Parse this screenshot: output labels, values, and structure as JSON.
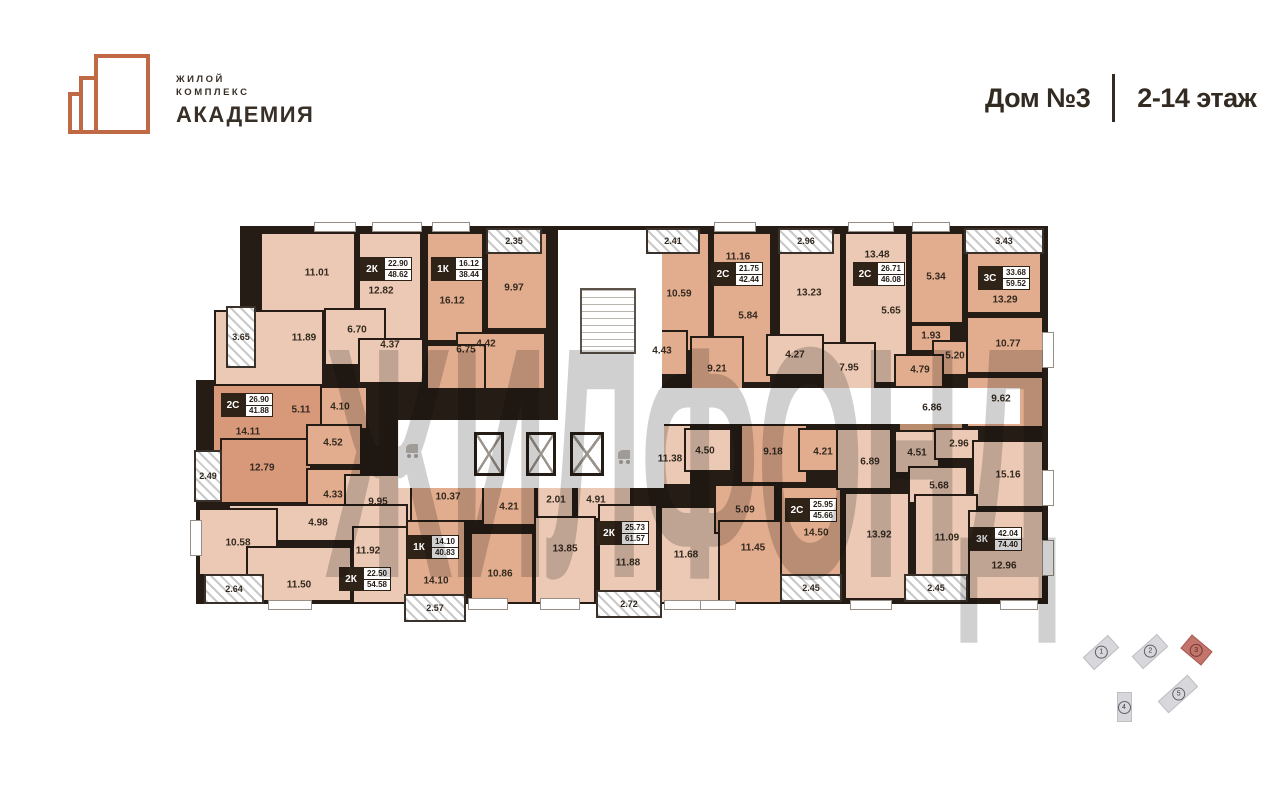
{
  "header": {
    "logo_line1": "ЖИЛОЙ",
    "logo_line2": "КОМПЛЕКС",
    "logo_name": "АКАДЕМИЯ",
    "house": "Дом №3",
    "floors": "2-14 этаж"
  },
  "watermark": "ЖИЛФОНД",
  "colors": {
    "brand": "#c06a45",
    "wall": "#251d15",
    "room_light": "#ecc9b4",
    "room_mid": "#e2ad8e",
    "room_dark": "#d8997a",
    "room_deep": "#b98c6d",
    "minimap_highlight": "#c4756b"
  },
  "plan": {
    "apartments": [
      {
        "type": "2К",
        "living": "22.90",
        "total": "48.62",
        "x": 360,
        "y": 257
      },
      {
        "type": "1К",
        "living": "16.12",
        "total": "38.44",
        "x": 431,
        "y": 257
      },
      {
        "type": "2С",
        "living": "21.75",
        "total": "42.44",
        "x": 711,
        "y": 262
      },
      {
        "type": "2С",
        "living": "26.71",
        "total": "46.08",
        "x": 853,
        "y": 262
      },
      {
        "type": "3С",
        "living": "33.68",
        "total": "59.52",
        "x": 978,
        "y": 266
      },
      {
        "type": "2С",
        "living": "26.90",
        "total": "41.88",
        "x": 221,
        "y": 393
      },
      {
        "type": "1К",
        "living": "14.10",
        "total": "40.83",
        "x": 407,
        "y": 535
      },
      {
        "type": "2К",
        "living": "22.50",
        "total": "54.58",
        "x": 339,
        "y": 567
      },
      {
        "type": "2К",
        "living": "25.73",
        "total": "61.57",
        "x": 597,
        "y": 521
      },
      {
        "type": "2С",
        "living": "25.95",
        "total": "45.66",
        "x": 785,
        "y": 498
      },
      {
        "type": "3К",
        "living": "42.04",
        "total": "74.40",
        "x": 970,
        "y": 527
      }
    ],
    "rooms": [
      {
        "r": [
          260,
          232,
          96,
          88
        ],
        "f": "light"
      },
      {
        "r": [
          358,
          232,
          64,
          120
        ],
        "f": "light"
      },
      {
        "r": [
          324,
          308,
          62,
          58
        ],
        "f": "light"
      },
      {
        "r": [
          358,
          338,
          66,
          46
        ],
        "f": "light"
      },
      {
        "r": [
          214,
          310,
          110,
          82
        ],
        "f": "light"
      },
      {
        "r": [
          426,
          232,
          58,
          110
        ],
        "f": "mid"
      },
      {
        "r": [
          486,
          232,
          62,
          98
        ],
        "f": "mid"
      },
      {
        "r": [
          456,
          332,
          90,
          58
        ],
        "f": "mid"
      },
      {
        "r": [
          426,
          344,
          60,
          46
        ],
        "f": "mid"
      },
      {
        "r": [
          646,
          232,
          64,
          120
        ],
        "f": "mid"
      },
      {
        "r": [
          712,
          232,
          60,
          152
        ],
        "f": "mid"
      },
      {
        "r": [
          638,
          330,
          50,
          46
        ],
        "f": "mid"
      },
      {
        "r": [
          690,
          336,
          54,
          68
        ],
        "f": "mid"
      },
      {
        "r": [
          778,
          232,
          64,
          114
        ],
        "f": "light"
      },
      {
        "r": [
          844,
          232,
          64,
          152
        ],
        "f": "light"
      },
      {
        "r": [
          766,
          334,
          58,
          42
        ],
        "f": "light"
      },
      {
        "r": [
          822,
          342,
          54,
          52
        ],
        "f": "light"
      },
      {
        "r": [
          910,
          232,
          54,
          92
        ],
        "f": "mid"
      },
      {
        "r": [
          966,
          232,
          76,
          82
        ],
        "f": "mid"
      },
      {
        "r": [
          910,
          324,
          42,
          28
        ],
        "f": "mid"
      },
      {
        "r": [
          932,
          340,
          50,
          36
        ],
        "f": "mid"
      },
      {
        "r": [
          894,
          354,
          50,
          34
        ],
        "f": "mid"
      },
      {
        "r": [
          966,
          316,
          78,
          58
        ],
        "f": "mid"
      },
      {
        "r": [
          966,
          376,
          78,
          52
        ],
        "f": "mid"
      },
      {
        "r": [
          898,
          388,
          66,
          44
        ],
        "f": "deep"
      },
      {
        "r": [
          212,
          384,
          136,
          72
        ],
        "f": "dark"
      },
      {
        "r": [
          320,
          386,
          48,
          44
        ],
        "f": "mid"
      },
      {
        "r": [
          220,
          438,
          92,
          66
        ],
        "f": "dark"
      },
      {
        "r": [
          306,
          424,
          56,
          42
        ],
        "f": "mid"
      },
      {
        "r": [
          306,
          468,
          56,
          46
        ],
        "f": "mid"
      },
      {
        "r": [
          344,
          474,
          82,
          50
        ],
        "f": "light"
      },
      {
        "r": [
          228,
          504,
          180,
          38
        ],
        "f": "light"
      },
      {
        "r": [
          198,
          508,
          80,
          68
        ],
        "f": "light"
      },
      {
        "r": [
          246,
          546,
          106,
          56
        ],
        "f": "light"
      },
      {
        "r": [
          352,
          526,
          76,
          78
        ],
        "f": "light"
      },
      {
        "r": [
          410,
          474,
          76,
          48
        ],
        "f": "mid"
      },
      {
        "r": [
          482,
          480,
          54,
          46
        ],
        "f": "mid"
      },
      {
        "r": [
          406,
          520,
          60,
          84
        ],
        "f": "mid"
      },
      {
        "r": [
          470,
          532,
          64,
          72
        ],
        "f": "mid"
      },
      {
        "r": [
          536,
          484,
          38,
          34
        ],
        "f": "light"
      },
      {
        "r": [
          576,
          482,
          56,
          38
        ],
        "f": "light"
      },
      {
        "r": [
          534,
          516,
          62,
          88
        ],
        "f": "light"
      },
      {
        "r": [
          598,
          504,
          60,
          100
        ],
        "f": "light"
      },
      {
        "r": [
          660,
          506,
          64,
          98
        ],
        "f": "light"
      },
      {
        "r": [
          634,
          424,
          58,
          62
        ],
        "f": "light"
      },
      {
        "r": [
          684,
          428,
          48,
          44
        ],
        "f": "light"
      },
      {
        "r": [
          740,
          424,
          68,
          60
        ],
        "f": "mid"
      },
      {
        "r": [
          798,
          428,
          52,
          44
        ],
        "f": "mid"
      },
      {
        "r": [
          714,
          484,
          62,
          50
        ],
        "f": "mid"
      },
      {
        "r": [
          718,
          520,
          68,
          84
        ],
        "f": "mid"
      },
      {
        "r": [
          780,
          486,
          62,
          100
        ],
        "f": "mid"
      },
      {
        "r": [
          836,
          428,
          56,
          62
        ],
        "f": "light"
      },
      {
        "r": [
          894,
          430,
          46,
          44
        ],
        "f": "light"
      },
      {
        "r": [
          934,
          428,
          46,
          32
        ],
        "f": "light"
      },
      {
        "r": [
          908,
          466,
          60,
          38
        ],
        "f": "light"
      },
      {
        "r": [
          972,
          440,
          72,
          68
        ],
        "f": "light"
      },
      {
        "r": [
          844,
          492,
          66,
          108
        ],
        "f": "light"
      },
      {
        "r": [
          914,
          494,
          64,
          106
        ],
        "f": "light"
      },
      {
        "r": [
          968,
          510,
          76,
          90
        ],
        "f": "light"
      }
    ],
    "labels": [
      {
        "t": "11.01",
        "x": 317,
        "y": 273
      },
      {
        "t": "12.82",
        "x": 381,
        "y": 291
      },
      {
        "t": "6.70",
        "x": 357,
        "y": 330
      },
      {
        "t": "4.37",
        "x": 390,
        "y": 345
      },
      {
        "t": "11.89",
        "x": 304,
        "y": 338
      },
      {
        "t": "16.12",
        "x": 452,
        "y": 301
      },
      {
        "t": "9.97",
        "x": 514,
        "y": 288
      },
      {
        "t": "4.42",
        "x": 486,
        "y": 344
      },
      {
        "t": "6.75",
        "x": 466,
        "y": 350
      },
      {
        "t": "10.59",
        "x": 679,
        "y": 294
      },
      {
        "t": "11.16",
        "x": 738,
        "y": 257
      },
      {
        "t": "5.84",
        "x": 748,
        "y": 316
      },
      {
        "t": "4.43",
        "x": 662,
        "y": 351
      },
      {
        "t": "9.21",
        "x": 717,
        "y": 369
      },
      {
        "t": "13.23",
        "x": 809,
        "y": 293
      },
      {
        "t": "13.48",
        "x": 877,
        "y": 255
      },
      {
        "t": "5.65",
        "x": 891,
        "y": 311
      },
      {
        "t": "4.27",
        "x": 795,
        "y": 355
      },
      {
        "t": "7.95",
        "x": 849,
        "y": 368
      },
      {
        "t": "13.29",
        "x": 1005,
        "y": 300
      },
      {
        "t": "5.34",
        "x": 936,
        "y": 277
      },
      {
        "t": "1.93",
        "x": 931,
        "y": 336
      },
      {
        "t": "5.20",
        "x": 955,
        "y": 356
      },
      {
        "t": "4.79",
        "x": 920,
        "y": 370
      },
      {
        "t": "10.77",
        "x": 1008,
        "y": 344
      },
      {
        "t": "9.62",
        "x": 1001,
        "y": 399
      },
      {
        "t": "6.86",
        "x": 932,
        "y": 408
      },
      {
        "t": "14.11",
        "x": 248,
        "y": 432
      },
      {
        "t": "5.11",
        "x": 301,
        "y": 410
      },
      {
        "t": "4.10",
        "x": 340,
        "y": 407
      },
      {
        "t": "4.52",
        "x": 333,
        "y": 443
      },
      {
        "t": "12.79",
        "x": 262,
        "y": 468
      },
      {
        "t": "4.33",
        "x": 333,
        "y": 495
      },
      {
        "t": "9.95",
        "x": 378,
        "y": 502
      },
      {
        "t": "4.98",
        "x": 318,
        "y": 523
      },
      {
        "t": "10.58",
        "x": 238,
        "y": 543
      },
      {
        "t": "11.50",
        "x": 299,
        "y": 585
      },
      {
        "t": "11.92",
        "x": 368,
        "y": 551
      },
      {
        "t": "10.37",
        "x": 448,
        "y": 497
      },
      {
        "t": "4.21",
        "x": 509,
        "y": 507
      },
      {
        "t": "14.10",
        "x": 436,
        "y": 581
      },
      {
        "t": "10.86",
        "x": 500,
        "y": 574
      },
      {
        "t": "2.01",
        "x": 556,
        "y": 500
      },
      {
        "t": "4.91",
        "x": 596,
        "y": 500
      },
      {
        "t": "13.85",
        "x": 565,
        "y": 549
      },
      {
        "t": "11.88",
        "x": 628,
        "y": 563
      },
      {
        "t": "11.68",
        "x": 686,
        "y": 555
      },
      {
        "t": "11.38",
        "x": 670,
        "y": 459
      },
      {
        "t": "4.50",
        "x": 705,
        "y": 451
      },
      {
        "t": "9.18",
        "x": 773,
        "y": 452
      },
      {
        "t": "4.21",
        "x": 823,
        "y": 452
      },
      {
        "t": "5.09",
        "x": 745,
        "y": 510
      },
      {
        "t": "11.45",
        "x": 753,
        "y": 548
      },
      {
        "t": "14.50",
        "x": 816,
        "y": 533
      },
      {
        "t": "13.92",
        "x": 879,
        "y": 535
      },
      {
        "t": "11.09",
        "x": 947,
        "y": 538
      },
      {
        "t": "12.96",
        "x": 1004,
        "y": 566
      },
      {
        "t": "6.89",
        "x": 870,
        "y": 462
      },
      {
        "t": "4.51",
        "x": 917,
        "y": 453
      },
      {
        "t": "2.96",
        "x": 959,
        "y": 444
      },
      {
        "t": "5.68",
        "x": 939,
        "y": 486
      },
      {
        "t": "15.16",
        "x": 1008,
        "y": 475
      }
    ],
    "balconies": [
      {
        "t": "2.35",
        "r": [
          486,
          228,
          56,
          26
        ]
      },
      {
        "t": "2.41",
        "r": [
          646,
          228,
          54,
          26
        ]
      },
      {
        "t": "2.96",
        "r": [
          778,
          228,
          56,
          26
        ]
      },
      {
        "t": "3.43",
        "r": [
          964,
          228,
          80,
          26
        ]
      },
      {
        "t": "3.65",
        "r": [
          226,
          306,
          30,
          62
        ]
      },
      {
        "t": "2.49",
        "r": [
          194,
          450,
          28,
          52
        ]
      },
      {
        "t": "2.64",
        "r": [
          204,
          574,
          60,
          30
        ]
      },
      {
        "t": "2.57",
        "r": [
          404,
          594,
          62,
          28
        ]
      },
      {
        "t": "2.72",
        "r": [
          596,
          590,
          66,
          28
        ]
      },
      {
        "t": "2.45",
        "r": [
          780,
          574,
          62,
          28
        ]
      },
      {
        "t": "2.45",
        "r": [
          904,
          574,
          64,
          28
        ]
      }
    ]
  },
  "minimap": {
    "buildings": [
      {
        "num": "1",
        "cx": 1101,
        "cy": 652,
        "w": 34,
        "h": 17,
        "rot": -42,
        "highlighted": false
      },
      {
        "num": "2",
        "cx": 1150,
        "cy": 651,
        "w": 34,
        "h": 17,
        "rot": -42,
        "highlighted": false
      },
      {
        "num": "3",
        "cx": 1196,
        "cy": 650,
        "w": 27,
        "h": 18,
        "rot": 40,
        "highlighted": true
      },
      {
        "num": "4",
        "cx": 1124,
        "cy": 707,
        "w": 15,
        "h": 30,
        "rot": 0,
        "highlighted": false
      },
      {
        "num": "5",
        "cx": 1178,
        "cy": 694,
        "w": 40,
        "h": 16,
        "rot": -42,
        "highlighted": false
      }
    ]
  }
}
